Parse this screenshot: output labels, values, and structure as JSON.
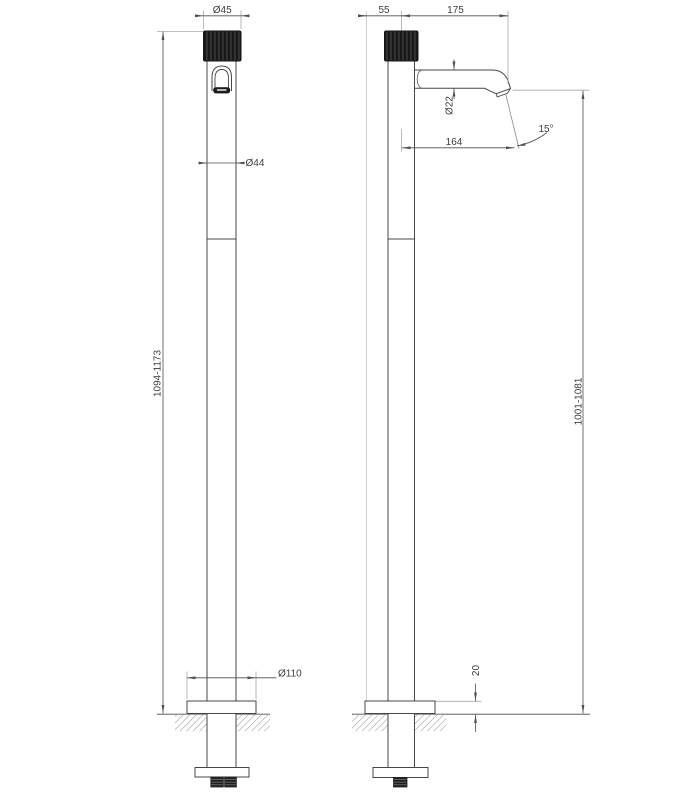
{
  "drawing": {
    "colors": {
      "background": "#ffffff",
      "outline": "#474747",
      "dimension_line": "#4f4f4f",
      "extension_line": "#a8a8a8",
      "handle_fill": "#181818",
      "text": "#3d3d3d"
    },
    "front_view": {
      "handle_diameter": "Ø45",
      "body_diameter": "Ø44",
      "base_diameter": "Ø110",
      "height_range": "1094-1173"
    },
    "side_view": {
      "base_radius": "55",
      "spout_reach": "175",
      "spout_diameter": "Ø22",
      "spout_projection": "164",
      "outlet_angle": "15°",
      "height_range": "1001-1081",
      "base_plate_height": "20"
    }
  }
}
